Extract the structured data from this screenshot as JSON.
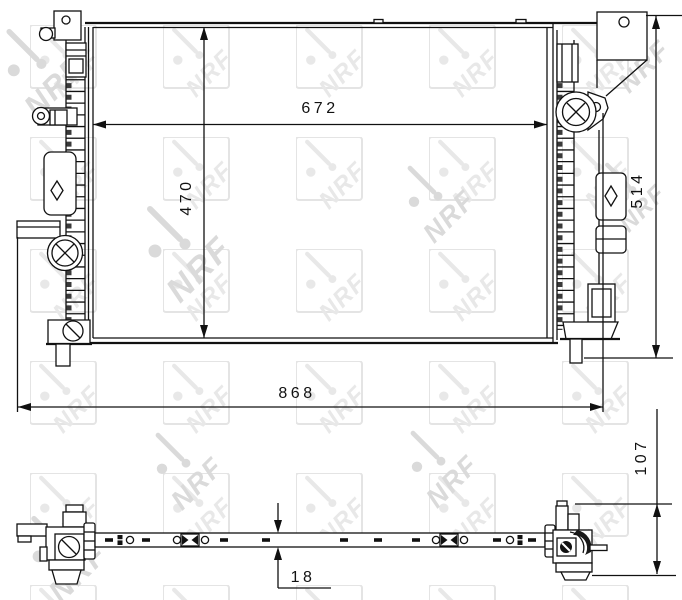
{
  "meta": {
    "drawing_type": "radiator-technical-drawing",
    "brand_watermark": "NRF"
  },
  "colors": {
    "line": "#111111",
    "background": "#ffffff",
    "watermark_box": "#e4e4e4",
    "watermark_tile_logo": "#e8e8e8",
    "watermark_large_logo": "#dadada"
  },
  "views": {
    "front": {
      "dimensions": {
        "core_width": "672",
        "core_height": "470",
        "overall_height": "514",
        "overall_width": "868"
      }
    },
    "bottom": {
      "dimensions": {
        "overall_depth": "107",
        "core_depth": "18"
      }
    }
  }
}
